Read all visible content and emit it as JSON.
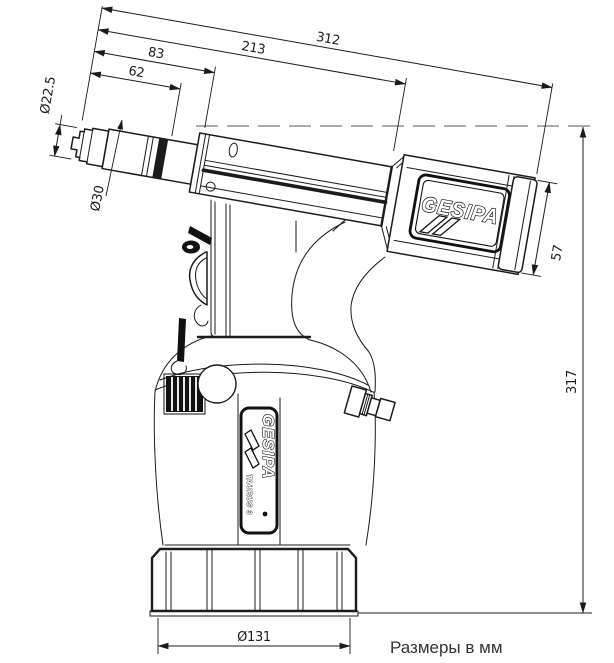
{
  "drawing": {
    "caption": "Размеры в мм",
    "line_color": "#1b1b1b",
    "reference_line_color": "#8f8f8f",
    "dimensions": {
      "overall_length": "312",
      "body_length": "213",
      "nose_length": "83",
      "sleeve_length": "62",
      "tip_diameter": "Ø22.5",
      "sleeve_diameter": "Ø30",
      "tail_cap_diameter": "57",
      "overall_height": "317",
      "base_diameter": "Ø131"
    },
    "branding": {
      "barrel_logo": "GESIPA",
      "body_logo": "GESIPA",
      "body_model": "TAURUS 3"
    }
  }
}
